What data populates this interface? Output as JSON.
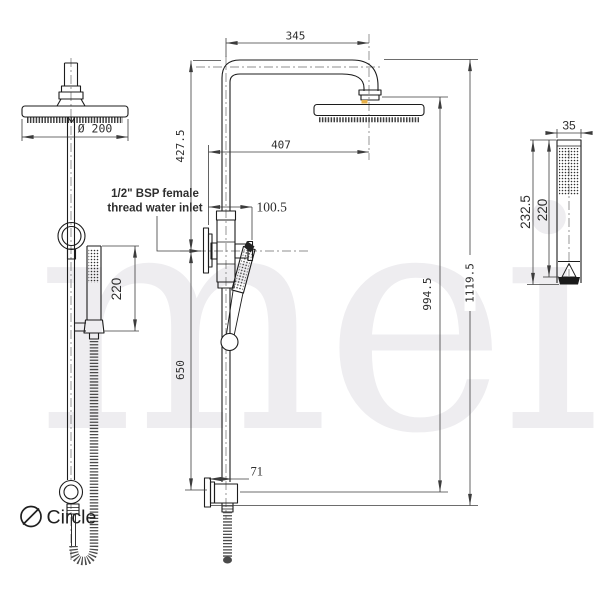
{
  "drawing": {
    "watermark": "meir",
    "notes": {
      "inlet_line1": "1/2\" BSP female",
      "inlet_line2": "thread water inlet",
      "circle_label": "Circle"
    },
    "dimensions": {
      "arm_reach": "345",
      "overhead_head_diameter": "Ø 200",
      "drop_to_inlet": "427.5",
      "head_wall_offset": "407",
      "inlet_offset": "100.5",
      "front_handpiece_travel": "220",
      "lower_rail_length": "650",
      "bottom_bracket_offset": "71",
      "head_face_height": "994.5",
      "overall_height": "1119.5",
      "handpiece_width": "35",
      "handpiece_overall_length": "232.5",
      "handpiece_body_length": "220"
    },
    "colors": {
      "line": "#1c1c1c",
      "dimension": "#3c3c3c",
      "text": "#2e2e2e",
      "watermark": "#eeedf0",
      "accent": "#e6b04a"
    }
  }
}
